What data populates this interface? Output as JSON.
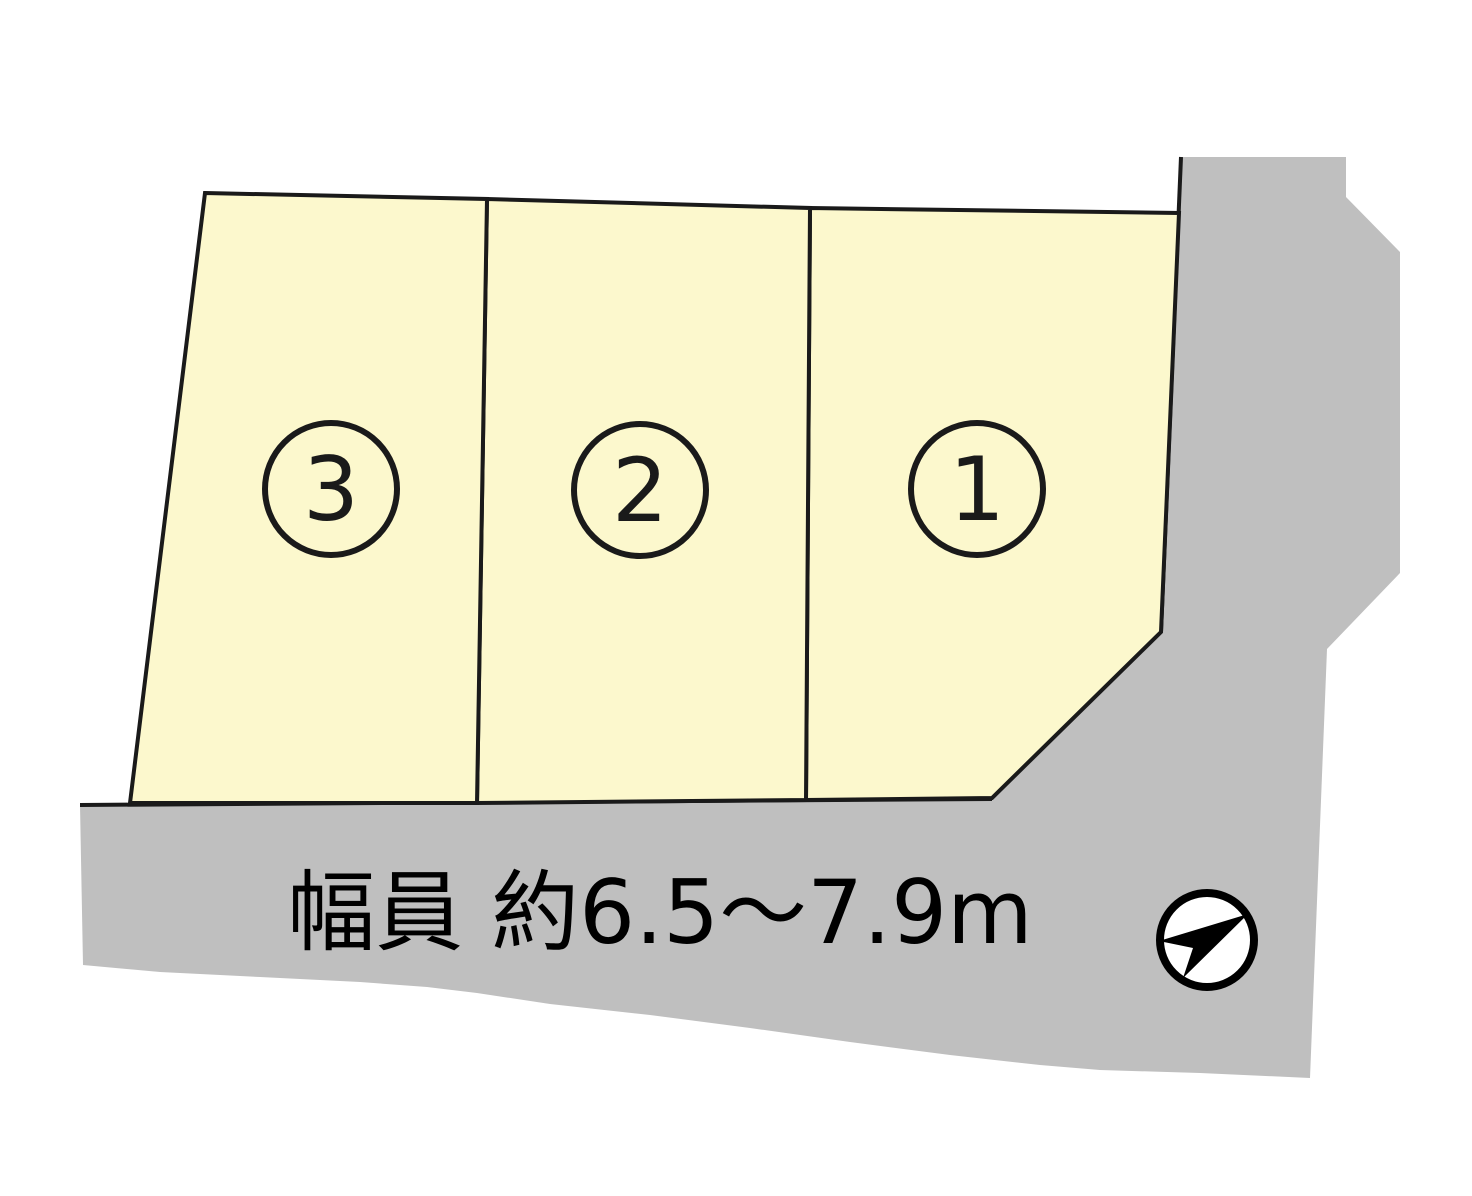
{
  "page": {
    "width": 1472,
    "height": 1196,
    "background": "#ffffff"
  },
  "road": {
    "fill": "#bfbfbf",
    "outline_points": "80,805 992,799 1161,632 1181,157 1346,157 1346,197 1400,252 1400,573 1327,649 1310,1078 1200,1073 1100,1070 1040,1065 950,1055 850,1042 750,1028 650,1015 550,1004 477,993 427,987 360,982 260,977 160,972 83,965",
    "top_edge_points": "80,805 992,799",
    "upper_right_edge_points": "1181,157 1161,632",
    "edge_color": "#1a1a1a",
    "edge_width": 4,
    "label": "幅員 約6.5〜7.9m",
    "label_color": "#000000",
    "label_x": 660,
    "label_y": 943,
    "label_font_size": 88
  },
  "lots": {
    "fill": "#fcf8cd",
    "stroke": "#1a1a1a",
    "stroke_width": 4,
    "badge_radius": 66,
    "badge_stroke_width": 6,
    "number_font_size": 88,
    "items": [
      {
        "number": "1",
        "polygon": "810,208 1179,213 1161,632 992,798 806,800",
        "cx": 977,
        "cy": 489,
        "num_y": 520
      },
      {
        "number": "2",
        "polygon": "487,199 810,208 806,800 477,803",
        "cx": 640,
        "cy": 490,
        "num_y": 521
      },
      {
        "number": "3",
        "polygon": "205,193 487,199 477,803 130,803",
        "cx": 331,
        "cy": 489,
        "num_y": 520
      }
    ]
  },
  "compass": {
    "cx": 1207,
    "cy": 940,
    "radius": 47,
    "fill": "#ffffff",
    "ring_color": "#000000",
    "ring_width": 8,
    "arrow_points": "1248,914 1183,978 1193,948 1159,941",
    "arrow_color": "#000000"
  }
}
